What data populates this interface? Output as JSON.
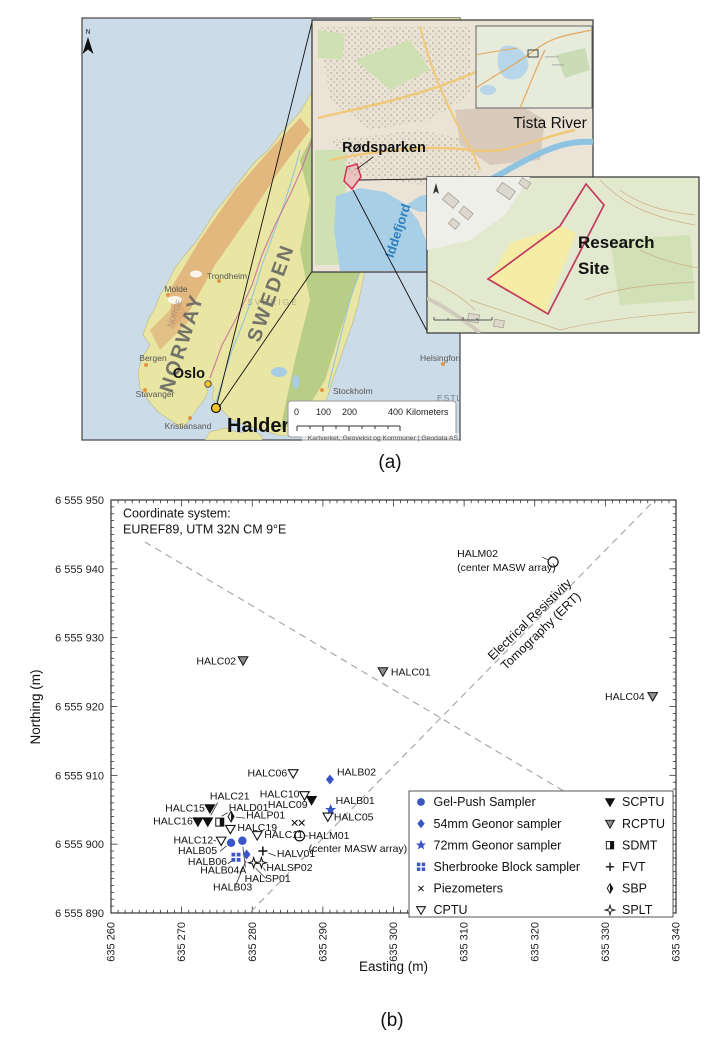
{
  "figure": {
    "caption_a": "(a)",
    "caption_b": "(b)"
  },
  "map": {
    "north_label": "N",
    "labels": {
      "norway": "NORWAY",
      "sweden": "SWEDEN",
      "norge": "NORGE",
      "sverige": "SVERIGE",
      "estland": "ESTLAND",
      "helsingfors": "Helsingfors",
      "stockholm": "Stockholm",
      "oslo": "Oslo",
      "halden": "Halden",
      "trondheim": "Trondheim",
      "molde": "Molde",
      "bergen": "Bergen",
      "stavanger": "Stavanger",
      "kristiansand": "Kristiansand"
    },
    "scalebar": {
      "t0": "0",
      "t100": "100",
      "t200": "200",
      "t400": "400",
      "unit": "Kilometers"
    },
    "attribution": "Kartverket, Geovekst og Kommuner | Geodata AS",
    "insets": {
      "tista": "Tista River",
      "rodsparken": "Rødsparken",
      "iddefjord": "Iddefjord",
      "research1": "Research",
      "research2": "Site"
    }
  },
  "chart_data": {
    "type": "scatter",
    "note": [
      "Coordinate system:",
      "EUREF89, UTM 32N CM 9°E"
    ],
    "xlabel": "Easting (m)",
    "ylabel": "Northing (m)",
    "xlim": [
      635260,
      635340
    ],
    "ylim": [
      6555890,
      6555950
    ],
    "xticks": [
      {
        "v": 635260,
        "label": "635 260"
      },
      {
        "v": 635270,
        "label": "635 270"
      },
      {
        "v": 635280,
        "label": "635 280"
      },
      {
        "v": 635290,
        "label": "635 290"
      },
      {
        "v": 635300,
        "label": "635 300"
      },
      {
        "v": 635310,
        "label": "635 310"
      },
      {
        "v": 635320,
        "label": "635 320"
      },
      {
        "v": 635330,
        "label": "635 330"
      },
      {
        "v": 635340,
        "label": "635 340"
      }
    ],
    "yticks": [
      {
        "v": 6555890,
        "label": "6 555 890"
      },
      {
        "v": 6555900,
        "label": "6 555 900"
      },
      {
        "v": 6555910,
        "label": "6 555 910"
      },
      {
        "v": 6555920,
        "label": "6 555 920"
      },
      {
        "v": 6555930,
        "label": "6 555 930"
      },
      {
        "v": 6555940,
        "label": "6 555 940"
      },
      {
        "v": 6555950,
        "label": "6 555 950"
      }
    ],
    "colors": {
      "sampler_blue": "#3a56c5",
      "rcptu_gray": "#8f8f8f",
      "dash_gray": "#a2a2a2"
    },
    "ert_label": [
      "Electrical Resistivity",
      "Tomography (ERT)"
    ],
    "ert_lines": [
      {
        "e1": 635264.8,
        "n1": 6555943.9,
        "e2": 635331.5,
        "n2": 6555903.2
      },
      {
        "e1": 635279.8,
        "n1": 6555890.2,
        "e2": 635336.5,
        "n2": 6555949.5
      }
    ],
    "points": [
      {
        "id": "HALM02",
        "type": "masw",
        "e": 635322.6,
        "n": 6555941.0,
        "label": {
          "lines": [
            "HALM02",
            "(center MASW array)"
          ],
          "anchor": "start",
          "dx": -96,
          "dy": -5,
          "line2dy": 14
        },
        "leader_seg": [
          -5,
          -2,
          -11,
          -5
        ]
      },
      {
        "id": "HALC01",
        "type": "rcptu",
        "e": 635298.5,
        "n": 6555925.1,
        "label": {
          "lines": [
            "HALC01"
          ],
          "anchor": "start",
          "dx": 8,
          "dy": 4
        }
      },
      {
        "id": "HALC02",
        "type": "rcptu",
        "e": 635278.7,
        "n": 6555926.7,
        "label": {
          "lines": [
            "HALC02"
          ],
          "anchor": "end",
          "dx": -7,
          "dy": 4
        }
      },
      {
        "id": "HALC04",
        "type": "rcptu",
        "e": 635336.7,
        "n": 6555921.5,
        "label": {
          "lines": [
            "HALC04"
          ],
          "anchor": "end",
          "dx": -8,
          "dy": 4
        }
      },
      {
        "id": "HALC06",
        "type": "cptu",
        "e": 635285.8,
        "n": 6555910.3,
        "label": {
          "lines": [
            "HALC06"
          ],
          "anchor": "end",
          "dx": -6,
          "dy": 3
        }
      },
      {
        "id": "HALB02",
        "type": "geonor54",
        "e": 635291.0,
        "n": 6555909.4,
        "label": {
          "lines": [
            "HALB02"
          ],
          "anchor": "start",
          "dx": 7,
          "dy": -4
        }
      },
      {
        "id": "HALC10",
        "type": "cptu",
        "e": 635287.4,
        "n": 6555907.1,
        "label": {
          "lines": [
            "HALC10"
          ],
          "anchor": "end",
          "dx": -5,
          "dy": 2
        }
      },
      {
        "id": "HALC09",
        "type": "scptu",
        "e": 635288.4,
        "n": 6555906.4,
        "label": {
          "lines": [
            "HALC09"
          ],
          "anchor": "end",
          "dx": -4,
          "dy": 8
        }
      },
      {
        "id": "HALB01",
        "type": "geonor72",
        "e": 635291.1,
        "n": 6555905.0,
        "label": {
          "lines": [
            "HALB01"
          ],
          "anchor": "start",
          "dx": 5,
          "dy": -6
        }
      },
      {
        "id": "HALC05",
        "type": "cptu",
        "e": 635290.7,
        "n": 6555904.0,
        "label": {
          "lines": [
            "HALC05"
          ],
          "anchor": "start",
          "dx": 6,
          "dy": 4
        }
      },
      {
        "id": "PZ1",
        "type": "piezo",
        "e": 635286.0,
        "n": 6555903.1
      },
      {
        "id": "PZ2",
        "type": "piezo",
        "e": 635287.0,
        "n": 6555903.1
      },
      {
        "id": "HALC11",
        "type": "cptu",
        "e": 635280.7,
        "n": 6555901.3,
        "label": {
          "lines": [
            "HALC11"
          ],
          "anchor": "start",
          "dx": 7,
          "dy": 3
        }
      },
      {
        "id": "HALM01",
        "type": "masw",
        "e": 635286.7,
        "n": 6555901.2,
        "label": {
          "lines": [
            "HALM01",
            "(center MASW array)"
          ],
          "anchor": "start",
          "dx": 9,
          "dy": 3,
          "line2dy": 13
        },
        "leader_seg": [
          5.2,
          0,
          8.2,
          0
        ]
      },
      {
        "id": "HALC12",
        "type": "cptu",
        "e": 635275.6,
        "n": 6555900.5,
        "label": {
          "lines": [
            "HALC12"
          ],
          "anchor": "end",
          "dx": -8,
          "dy": 3
        },
        "leader_seg": [
          -5.2,
          0,
          -7.8,
          0
        ]
      },
      {
        "id": "HALC15",
        "type": "scptu",
        "e": 635274.0,
        "n": 6555905.2,
        "label": {
          "lines": [
            "HALC15"
          ],
          "anchor": "end",
          "dx": -5,
          "dy": 3
        }
      },
      {
        "id": "HALC21",
        "type": "scptu",
        "e": 635273.7,
        "n": 6555903.3,
        "label": {
          "lines": [
            "HALC21"
          ],
          "anchor": "middle",
          "dx": 22,
          "dy": -22
        },
        "leader_seg": [
          3,
          -6,
          10,
          -19
        ]
      },
      {
        "id": "HALC16",
        "type": "scptu",
        "e": 635272.3,
        "n": 6555903.3,
        "label": {
          "lines": [
            "HALC16"
          ],
          "anchor": "end",
          "dx": -5,
          "dy": 3
        }
      },
      {
        "id": "HALD01",
        "type": "sdmt",
        "e": 635275.4,
        "n": 6555903.2,
        "label": {
          "lines": [
            "HALD01"
          ],
          "anchor": "start",
          "dx": 9,
          "dy": -11
        },
        "leader_seg": [
          2,
          -6,
          8,
          -9.5
        ]
      },
      {
        "id": "HALP01",
        "type": "sbp",
        "e": 635277.0,
        "n": 6555904.0,
        "label": {
          "lines": [
            "HALP01"
          ],
          "anchor": "start",
          "dx": 15,
          "dy": 2
        },
        "leader_seg": [
          5,
          0.5,
          14,
          1.5
        ]
      },
      {
        "id": "HALC19",
        "type": "cptu",
        "e": 635276.9,
        "n": 6555902.2,
        "label": {
          "lines": [
            "HALC19"
          ],
          "anchor": "start",
          "dx": 7,
          "dy": 2
        }
      },
      {
        "id": "HALB05",
        "type": "gelpush",
        "e": 635277.0,
        "n": 6555900.2,
        "label": {
          "lines": [
            "HALB05"
          ],
          "anchor": "end",
          "dx": -14,
          "dy": 11
        },
        "leader_seg": [
          -4.5,
          3,
          -11,
          8.5
        ]
      },
      {
        "id": "HALB04A",
        "type": "gelpush",
        "e": 635278.6,
        "n": 6555900.5,
        "label": {
          "lines": [
            "HALB04A"
          ],
          "anchor": "end",
          "dx": 4,
          "dy": 33
        },
        "leader_seg": [
          0.5,
          6,
          3,
          27
        ]
      },
      {
        "id": "HALB06",
        "type": "sherbrooke",
        "e": 635277.7,
        "n": 6555898.1,
        "label": {
          "lines": [
            "HALB06"
          ],
          "anchor": "end",
          "dx": -9,
          "dy": 8
        },
        "leader_seg": [
          -4,
          3.5,
          -8,
          6.5
        ]
      },
      {
        "id": "HALB03",
        "type": "geonor54",
        "e": 635279.2,
        "n": 6555898.5,
        "label": {
          "lines": [
            "HALB03"
          ],
          "anchor": "middle",
          "dx": -14,
          "dy": 36
        },
        "leader_seg": [
          -0.5,
          6,
          -11,
          31
        ]
      },
      {
        "id": "HALV01",
        "type": "fvt",
        "e": 635281.5,
        "n": 6555899.0,
        "label": {
          "lines": [
            "HALV01"
          ],
          "anchor": "start",
          "dx": 14,
          "dy": 6
        },
        "leader_seg": [
          5.5,
          2,
          13,
          5
        ]
      },
      {
        "id": "HALSP01",
        "type": "splt",
        "e": 635280.2,
        "n": 6555897.3,
        "label": {
          "lines": [
            "HALSP01"
          ],
          "anchor": "middle",
          "dx": 14,
          "dy": 19
        },
        "leader_seg": [
          2,
          5.5,
          12,
          15.5
        ]
      },
      {
        "id": "HALSP02",
        "type": "splt",
        "e": 635281.3,
        "n": 6555897.3,
        "label": {
          "lines": [
            "HALSP02"
          ],
          "anchor": "start",
          "dx": 5,
          "dy": 8
        },
        "leader_seg": [
          2,
          5,
          4,
          8
        ]
      }
    ],
    "legend": {
      "left": [
        {
          "type": "gelpush",
          "label": "Gel-Push Sampler"
        },
        {
          "type": "geonor54",
          "label": "54mm Geonor sampler"
        },
        {
          "type": "geonor72",
          "label": "72mm Geonor sampler"
        },
        {
          "type": "sherbrooke",
          "label": "Sherbrooke Block sampler"
        },
        {
          "type": "piezo",
          "label": "Piezometers"
        },
        {
          "type": "cptu",
          "label": "CPTU"
        }
      ],
      "right": [
        {
          "type": "scptu",
          "label": "SCPTU"
        },
        {
          "type": "rcptu",
          "label": "RCPTU"
        },
        {
          "type": "sdmt",
          "label": "SDMT"
        },
        {
          "type": "fvt",
          "label": "FVT"
        },
        {
          "type": "sbp",
          "label": "SBP"
        },
        {
          "type": "splt",
          "label": "SPLT"
        }
      ]
    }
  }
}
